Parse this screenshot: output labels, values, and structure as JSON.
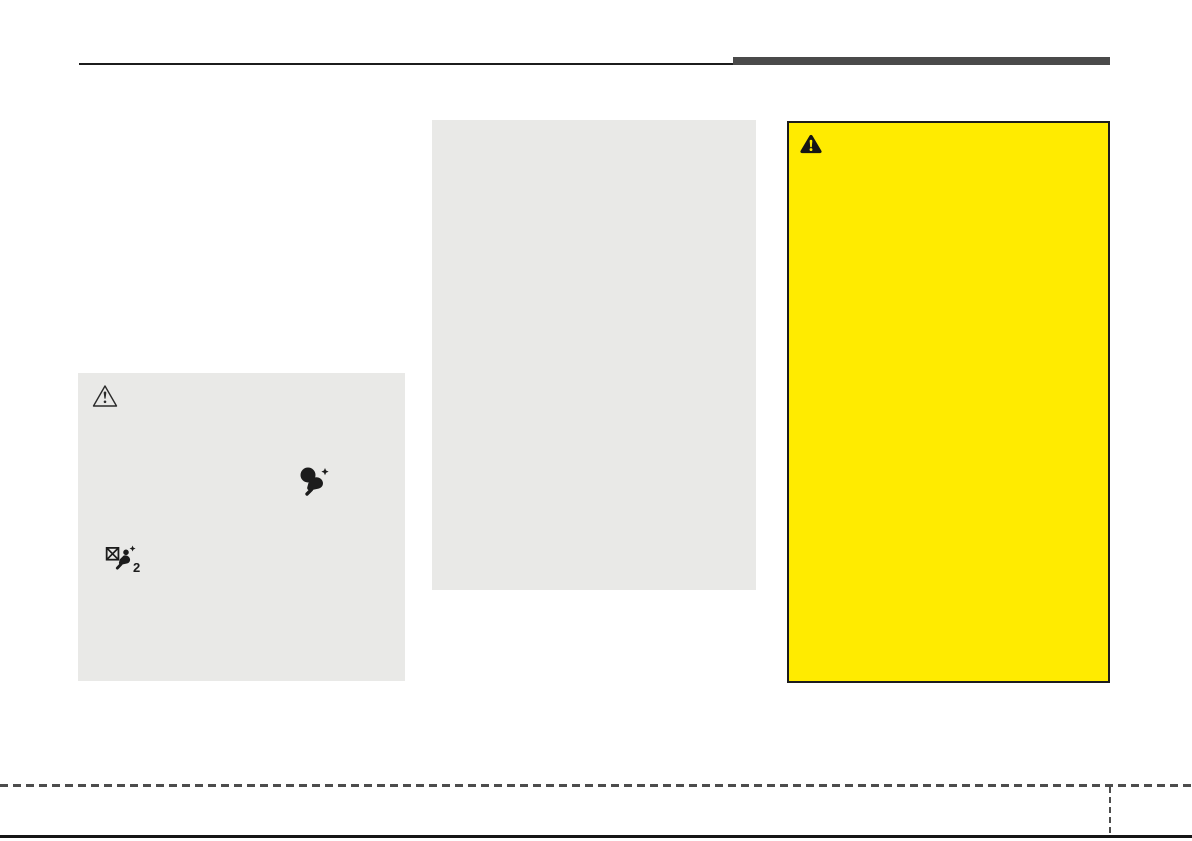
{
  "document": {
    "kind": "owners-manual-page",
    "visible_text": []
  },
  "colors": {
    "page_background": "#ffffff",
    "header_rule": "#1c1c1c",
    "header_tab_bar": "#4a4a4a",
    "note_box_background": "#e9e9e7",
    "warning_box_background": "#ffeb00",
    "warning_box_border": "#1c1c1c",
    "footer_dash": "#4d4d4d",
    "page_bottom_rule": "#161616",
    "icon_color": "#1c1c1c"
  },
  "note_box": {
    "icons": [
      {
        "name": "caution-triangle-outline-icon"
      },
      {
        "name": "airbag-deploy-icon"
      },
      {
        "name": "side-airbag-crossed-icon",
        "subscript": "2"
      }
    ]
  },
  "warning_box": {
    "icon": "warning-triangle-filled-icon"
  }
}
